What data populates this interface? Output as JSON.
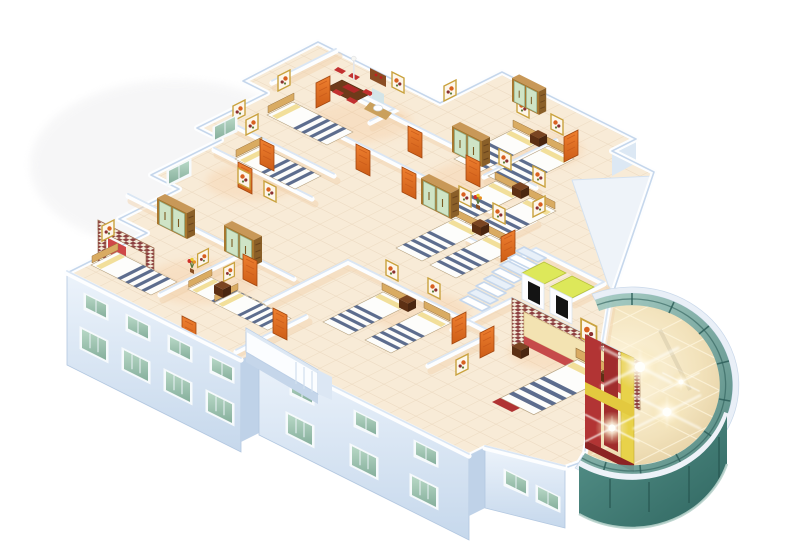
{
  "scene": {
    "title": "3D isometric cutaway floor plan render of a residential hotel floor with bedrooms and a curved glass atrium",
    "type": "architectural-3d-render",
    "view": "isometric cutaway, no roof, white background",
    "visible_text": []
  },
  "palette": {
    "bg": "#ffffff",
    "rim": "#c6d7ec",
    "wall_white": "#fdfeff",
    "wall_top": "#d8e5f3",
    "wall_shadow_warm": "#f1d3b0",
    "floor_base": "#f8ebd7",
    "floor_tile_line": "#e7d3b8",
    "floor_warm_glow": "#f5bf8c",
    "ext_wall_1": "#ecf3fb",
    "ext_wall_2": "#c6d8ec",
    "ext_wall_dark": "#b2c7e0",
    "window_frame": "#f6fafc",
    "window_glass_1": "#b8d8c6",
    "window_glass_2": "#86af9c",
    "door_1": "#ef8030",
    "door_2": "#cd5d17",
    "wood_light": "#d9ab62",
    "wood_mid": "#a8772e",
    "wood_dark": "#6e3a1a",
    "wardrobe_door_green": "#cfe4c6",
    "stripe_navy": "#5d6d8e",
    "pillow_yellow": "#f2df9a",
    "bed_linen": "#fdfdfb",
    "headboard_red": "#cf4848",
    "checker_red": "#8d4040",
    "painting_frame_gold": "#c9a23e",
    "atrium_rim": "#e9eff7",
    "atrium_glass_1": "#a9cfc6",
    "atrium_glass_2": "#447e76",
    "atrium_glass_3": "#58948c",
    "atrium_glass_4": "#2f6660",
    "atrium_mullion": "#2e5f5a",
    "atrium_floor_1": "#fff7e0",
    "atrium_floor_2": "#ddc596",
    "atrium_grid": "#fff7e0",
    "flare": "#fffdf2",
    "feature_red_1": "#b23434",
    "feature_red_2": "#a02c2c",
    "feature_yellow_1": "#e8d24a",
    "feature_yellow_2": "#e3c93f",
    "elevator_floor": "#dde85a",
    "elevator_door": "#141414",
    "stair_fill": "#ffffff",
    "stair_alt": "#e8f0f9",
    "stair_edge": "#bcd2e8",
    "ramp_shadow": "#c5d6ea",
    "chair_red": "#c23030"
  },
  "building": {
    "wings": [
      {
        "name": "top-left-wing",
        "rooms": [
          "dining-room",
          "double-bedroom-1",
          "double-bedroom-2",
          "washroom"
        ]
      },
      {
        "name": "right-wing",
        "rooms": [
          "twin-bedroom-1",
          "twin-bedroom-2",
          "twin-bedroom-3"
        ]
      },
      {
        "name": "left-wing",
        "rooms": [
          "canopy-bedroom",
          "twin-bedroom-4"
        ]
      },
      {
        "name": "center",
        "rooms": [
          "corridor",
          "twin-bedroom-5",
          "stair-hall",
          "elevator-lobby",
          "master-bedroom"
        ]
      },
      {
        "name": "atrium",
        "rooms": [
          "glass-atrium-lobby"
        ]
      }
    ],
    "furniture": {
      "beds": 13,
      "wardrobes": 5,
      "nightstands": 5,
      "orange_doors": 14,
      "wall_paintings": 16,
      "dining_table_with_red_chairs": 1,
      "washbasin": 1,
      "elevators": 2,
      "interior_staircase_steps": 8,
      "exterior_ramp": 1,
      "flower_vases": 2
    },
    "facade": {
      "stories_below_cut": 2,
      "window_rows_left_wing": 2,
      "window_glass_color": "teal-green",
      "wall_color": "pale blue-white"
    },
    "atrium": {
      "shape": "curved glass curtain wall, ~240 degree arc",
      "ceiling_light_flares": 4,
      "floor": "polished beige marble with white diamond grid",
      "feature_wall": "red panels with yellow bands and yellow pillar",
      "lower_storey_glass_band": true
    }
  }
}
